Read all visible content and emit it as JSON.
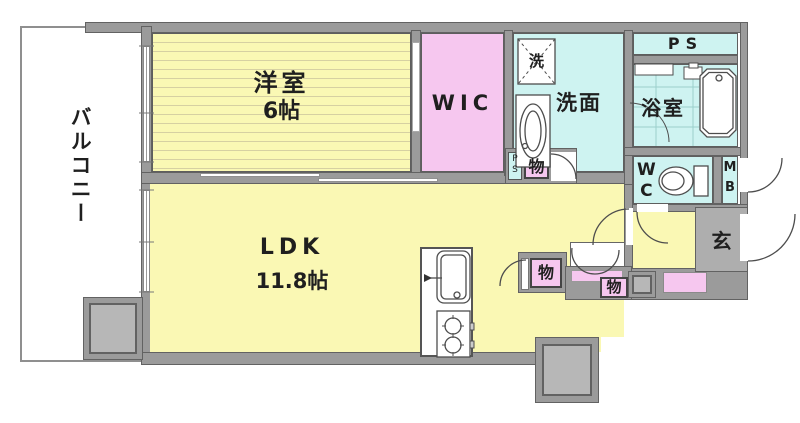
{
  "colors": {
    "room_yellow": "#FAF8B4",
    "room_yellow_stripe": "#D6D0A2",
    "room_pink": "#F6C7EF",
    "room_cyan": "#CEF3F1",
    "wall_fill": "#9B9B9B",
    "wall_edge": "#626262",
    "genkan_fill": "#AEAEAE",
    "pillar_fill": "#B7B7B7",
    "fixture_stroke": "#4d4d4d",
    "bath_grid": "#9CCFCC"
  },
  "labels": {
    "balcony": "バルコニー",
    "bedroom_name": "洋室",
    "bedroom_size": "6帖",
    "wic": "WIC",
    "washer": "洗",
    "washroom": "洗面",
    "ps": "PS",
    "bath": "浴室",
    "wc_line1": "W",
    "wc_line2": "C",
    "mb_line1": "M",
    "mb_line2": "B",
    "genkan": "玄",
    "ldk_name": "LDK",
    "ldk_size": "11.8帖",
    "storage_niche": "物",
    "storage_mid": "物",
    "storage_hall": "物",
    "ps_small_line1": "P",
    "ps_small_line2": "S"
  }
}
